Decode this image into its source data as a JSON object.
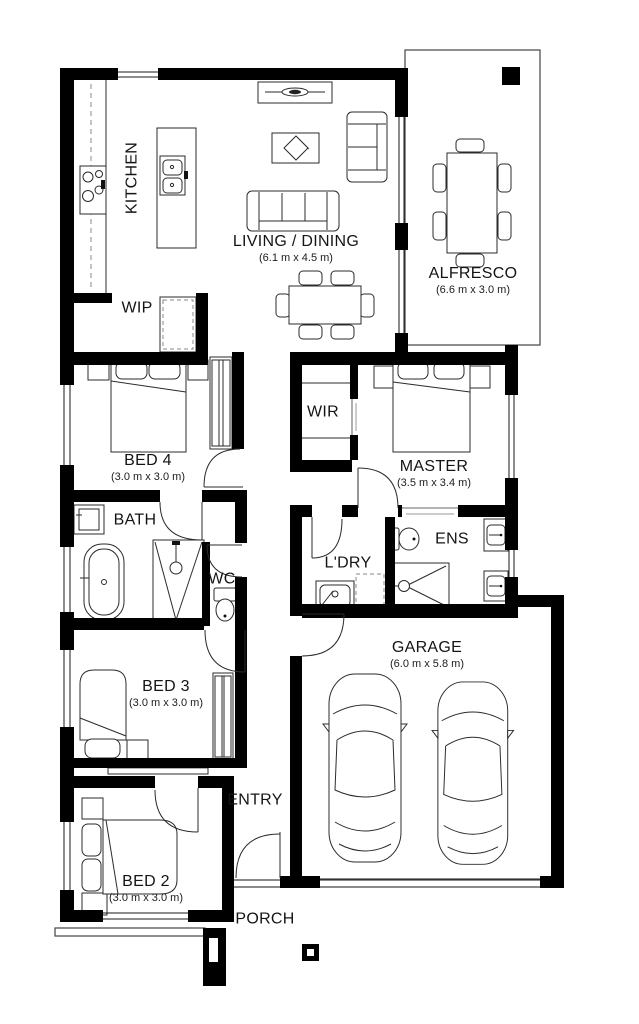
{
  "page": {
    "background": "#ffffff",
    "wall_color": "#000000",
    "line_color": "#2b2b2b",
    "muted_color": "#9a9a9a"
  },
  "rooms": [
    {
      "id": "kitchen",
      "name": "KITCHEN",
      "dims": ""
    },
    {
      "id": "living-dining",
      "name": "LIVING / DINING",
      "dims": "(6.1 m x 4.5 m)"
    },
    {
      "id": "alfresco",
      "name": "ALFRESCO",
      "dims": "(6.6 m x 3.0 m)"
    },
    {
      "id": "wip",
      "name": "WIP",
      "dims": ""
    },
    {
      "id": "bed4",
      "name": "BED 4",
      "dims": "(3.0 m x 3.0 m)"
    },
    {
      "id": "wir",
      "name": "WIR",
      "dims": ""
    },
    {
      "id": "master",
      "name": "MASTER",
      "dims": "(3.5 m x 3.4 m)"
    },
    {
      "id": "bath",
      "name": "BATH",
      "dims": ""
    },
    {
      "id": "wc",
      "name": "WC",
      "dims": ""
    },
    {
      "id": "ldry",
      "name": "L'DRY",
      "dims": ""
    },
    {
      "id": "ens",
      "name": "ENS",
      "dims": ""
    },
    {
      "id": "garage",
      "name": "GARAGE",
      "dims": "(6.0 m x 5.8 m)"
    },
    {
      "id": "bed3",
      "name": "BED 3",
      "dims": "(3.0 m x 3.0 m)"
    },
    {
      "id": "entry",
      "name": "ENTRY",
      "dims": ""
    },
    {
      "id": "bed2",
      "name": "BED 2",
      "dims": "(3.0 m x 3.0 m)"
    },
    {
      "id": "porch",
      "name": "PORCH",
      "dims": ""
    }
  ],
  "fixtures": [
    "island-bench",
    "cooktop",
    "double-sink",
    "pantry-cupboard",
    "tv-unit",
    "coffee-table",
    "sofa-3-seat",
    "sofa-2-seat",
    "dining-table",
    "dining-chairs",
    "outdoor-table",
    "outdoor-chairs",
    "double-bed",
    "single-bed",
    "wardrobe",
    "bathtub",
    "vanity",
    "shower",
    "toilet",
    "laundry-trough",
    "washing-machine-space",
    "car",
    "porch-column"
  ]
}
